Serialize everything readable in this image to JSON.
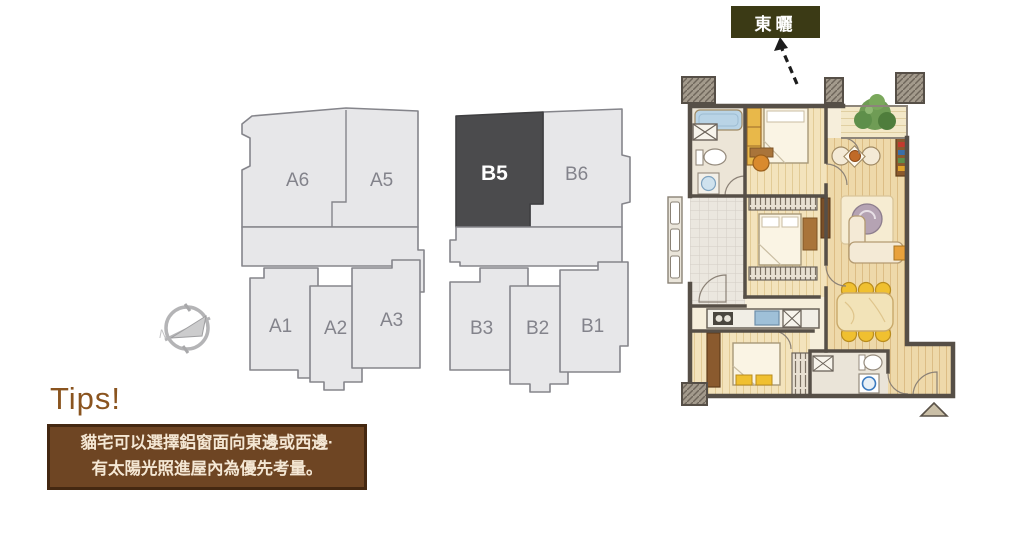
{
  "sun_callout": {
    "label": "東曬",
    "bg": "#3b3a15",
    "text_color": "#ffffff"
  },
  "building_a": {
    "units": {
      "a6": "A6",
      "a5": "A5",
      "a1": "A1",
      "a2": "A2",
      "a3": "A3"
    }
  },
  "building_b": {
    "units": {
      "b5": "B5",
      "b6": "B6",
      "b3": "B3",
      "b2": "B2",
      "b1": "B1"
    },
    "highlighted_unit": "B5",
    "highlight_color": "#4b4b4d"
  },
  "compass": {
    "label": "N"
  },
  "tips": {
    "heading": "Tips!",
    "line1": "貓宅可以選擇鋁窗面向東邊或西邊·",
    "line2": "有太陽光照進屋內為優先考量。",
    "heading_color": "#8a541f",
    "box_bg": "#6e4523",
    "box_border": "#442811",
    "box_text_color": "#f4e7d4"
  }
}
